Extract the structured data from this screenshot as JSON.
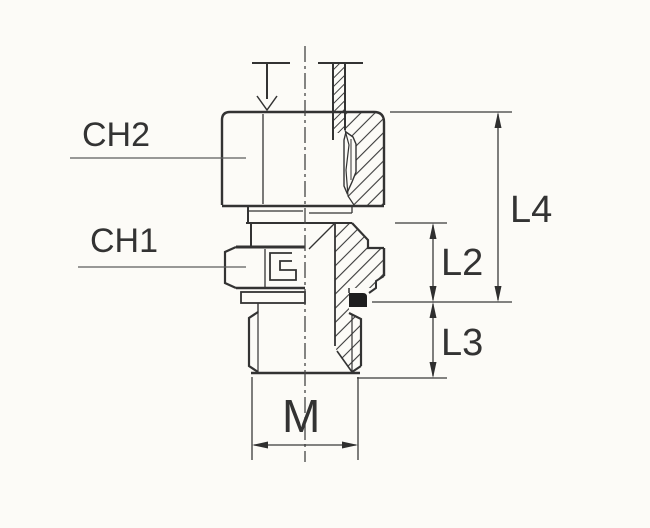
{
  "diagram": {
    "type": "technical-drawing",
    "subject": "Male stud fitting with cutting ring, half-section view with dimensions",
    "labels": {
      "ch2": "CH2",
      "ch1": "CH1",
      "l4": "L4",
      "l2": "L2",
      "l3": "L3",
      "m": "M"
    },
    "colors": {
      "background": "#fcfbf7",
      "line": "#333333",
      "seal": "#1e1e1e"
    }
  }
}
